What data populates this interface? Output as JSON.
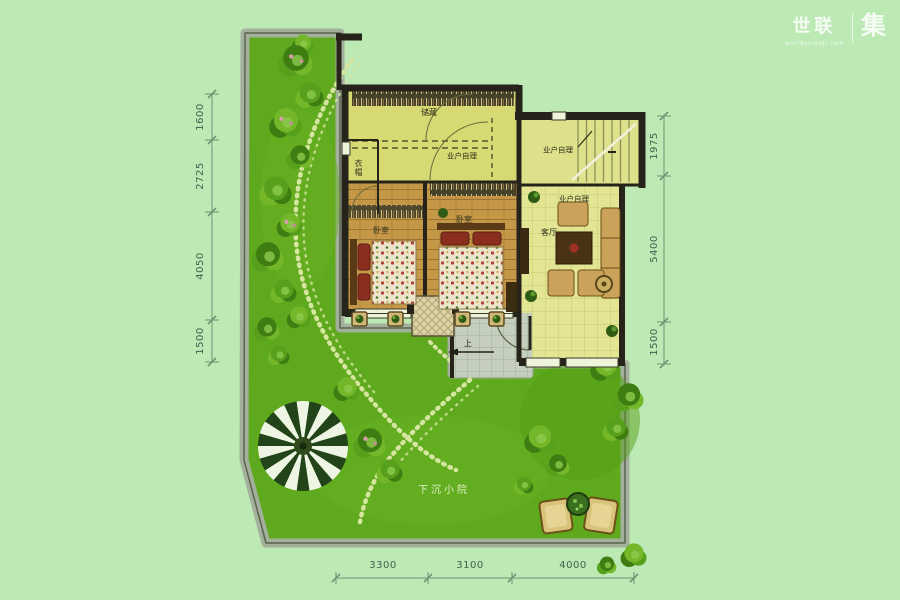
{
  "logo": {
    "brand": "世联",
    "url": "worldunionji.com",
    "unit": "集"
  },
  "rooms": {
    "storage": "储藏",
    "cloak": "衣帽",
    "bedroom1": "卧室",
    "bedroom2": "卧室",
    "living": "客厅",
    "up": "上",
    "courtyard": "下沉小院"
  },
  "annotations": {
    "note1": "业户自理",
    "note2": "业户自理",
    "note3": "业户自理"
  },
  "dimensions": {
    "left": [
      "1600",
      "2725",
      "4050",
      "1500"
    ],
    "right": [
      "1975",
      "5400",
      "1500"
    ],
    "bottom": [
      "3300",
      "3100",
      "4000"
    ]
  },
  "colors": {
    "background": "#bce9b4",
    "lawn": "#5ea91d",
    "garden_wall": "#a3b09c",
    "house_wall": "#26241a",
    "wood_floor": "#c59848",
    "pale_floor": "#e3e494",
    "storage_floor": "#d7da72",
    "terrace": "#c6cfbe",
    "dimension_text": "#44604d"
  }
}
